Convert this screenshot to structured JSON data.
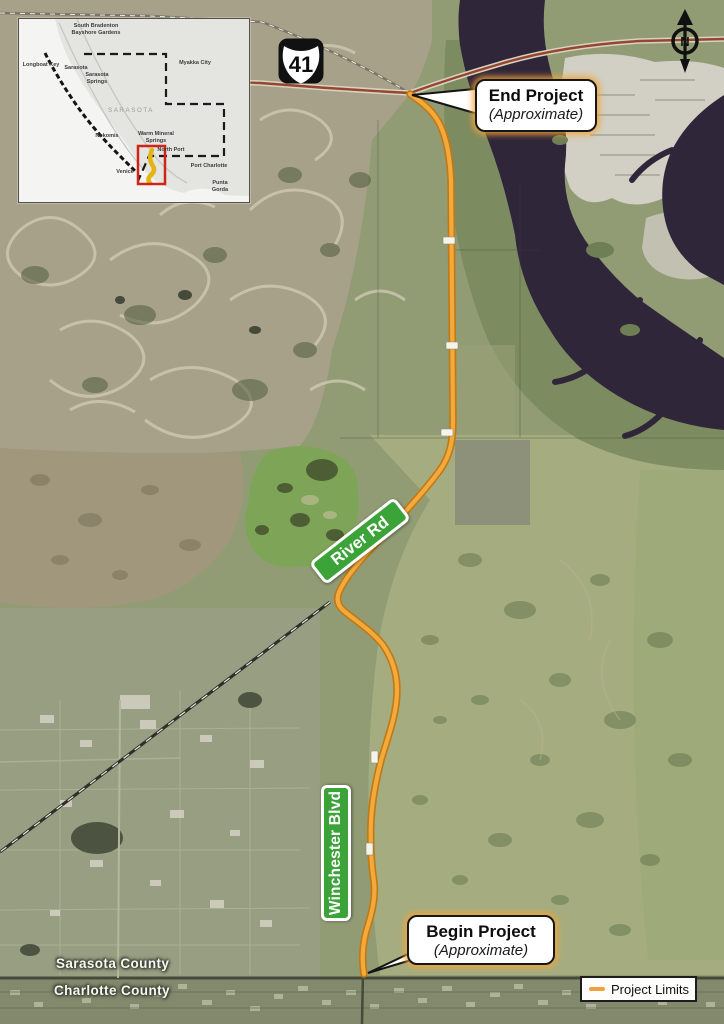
{
  "legend": {
    "label": "Project Limits"
  },
  "callouts": {
    "end": {
      "title": "End Project",
      "subtitle": "(Approximate)"
    },
    "begin": {
      "title": "Begin Project",
      "subtitle": "(Approximate)"
    }
  },
  "signs": {
    "river_rd": "River Rd",
    "winchester_blvd": "Winchester Blvd"
  },
  "highway": {
    "shield_number": "41"
  },
  "compass": {
    "label": "N"
  },
  "counties": {
    "north": "Sarasota County",
    "south": "Charlotte County"
  },
  "colors": {
    "project_limits_orange": "#F0A13C",
    "route_casing_orange": "#BF7A16",
    "road_sign_green": "#3BA338",
    "inset_highlight_red": "#CF2518",
    "inset_route_yellow": "#E4B410"
  },
  "inset": {
    "labels": [
      {
        "text": "South Bradenton\nBayshore Gardens"
      },
      {
        "text": "Longboat Key"
      },
      {
        "text": "Sarasota"
      },
      {
        "text": "Sarasota\nSprings"
      },
      {
        "text": "Myakka City"
      },
      {
        "text": "SARASOTA"
      },
      {
        "text": "Nokomis"
      },
      {
        "text": "Venice"
      },
      {
        "text": "Warm Mineral\nSprings"
      },
      {
        "text": "North Port"
      },
      {
        "text": "Port Charlotte"
      },
      {
        "text": "Punta Gorda"
      }
    ]
  }
}
